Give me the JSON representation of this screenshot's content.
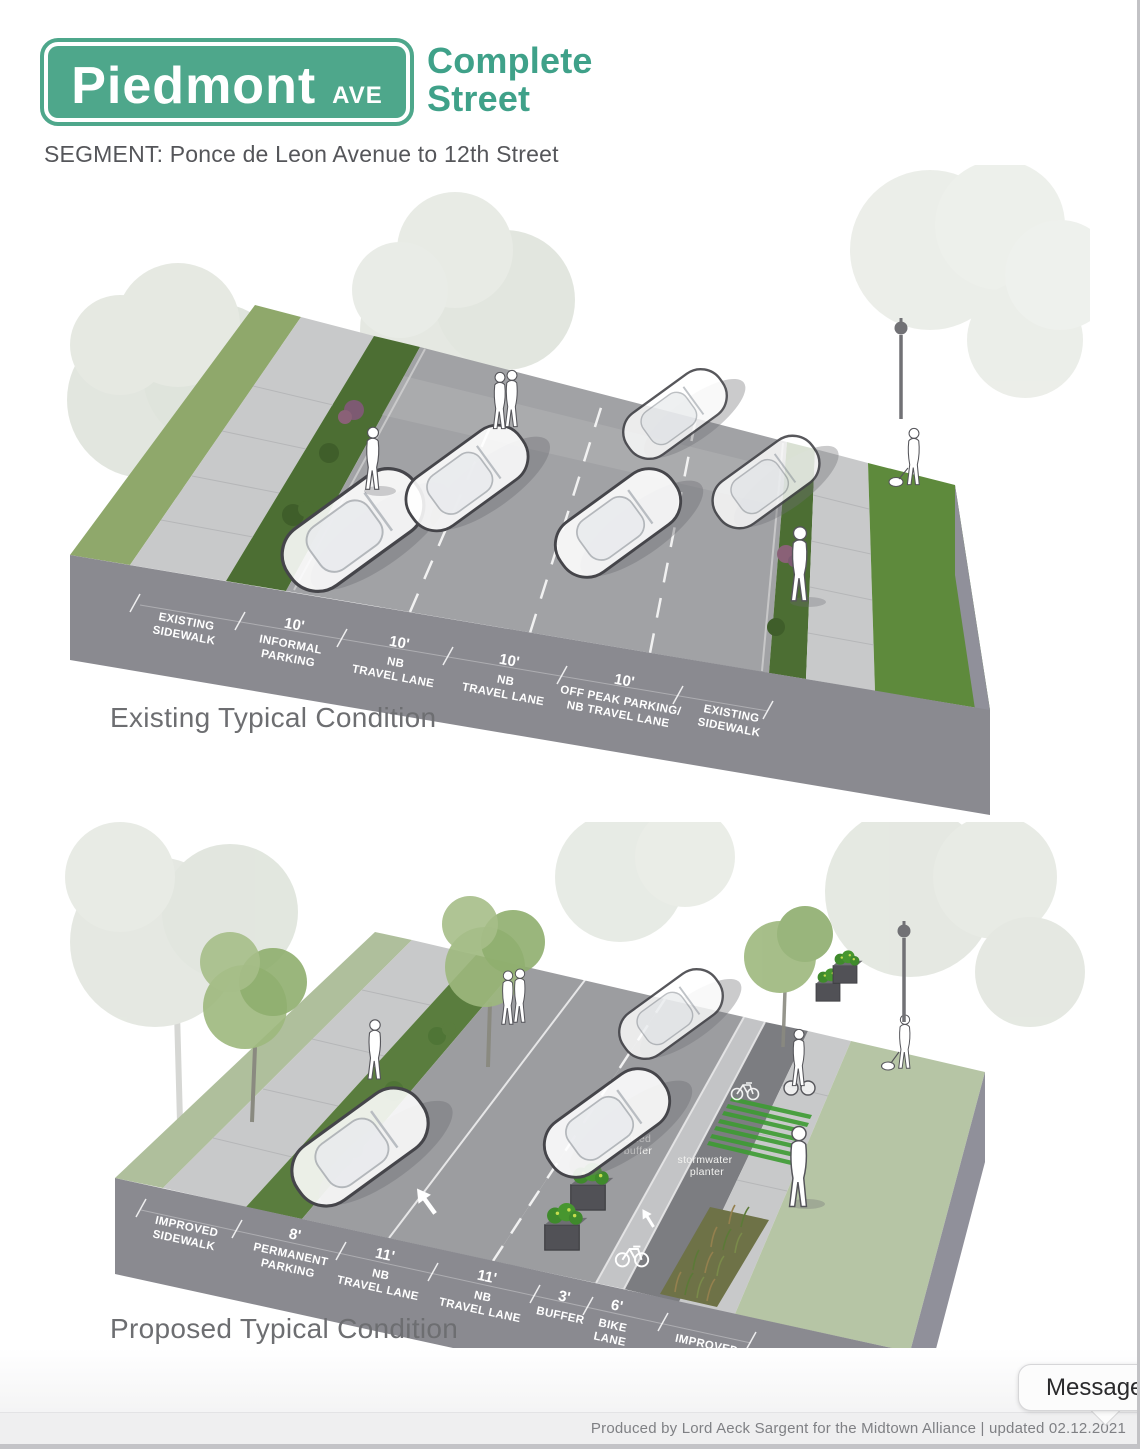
{
  "header": {
    "sign": {
      "name": "Piedmont",
      "suffix": "AVE"
    },
    "brand": {
      "line1": "Complete",
      "line2": "Street"
    },
    "segment": "SEGMENT: Ponce de Leon Avenue to 12th Street"
  },
  "existing": {
    "caption": "Existing Typical Condition",
    "segments": [
      {
        "dim": "",
        "l1": "EXISTING",
        "l2": "SIDEWALK"
      },
      {
        "dim": "10'",
        "l1": "INFORMAL",
        "l2": "PARKING"
      },
      {
        "dim": "10'",
        "l1": "NB",
        "l2": "TRAVEL LANE"
      },
      {
        "dim": "10'",
        "l1": "NB",
        "l2": "TRAVEL LANE"
      },
      {
        "dim": "10'",
        "l1": "OFF PEAK PARKING/",
        "l2": "NB TRAVEL LANE"
      },
      {
        "dim": "",
        "l1": "EXISTING",
        "l2": "SIDEWALK"
      }
    ]
  },
  "proposed": {
    "caption": "Proposed Typical Condition",
    "segments": [
      {
        "dim": "",
        "l1": "IMPROVED",
        "l2": "SIDEWALK"
      },
      {
        "dim": "8'",
        "l1": "PERMANENT",
        "l2": "PARKING"
      },
      {
        "dim": "11'",
        "l1": "NB",
        "l2": "TRAVEL LANE"
      },
      {
        "dim": "11'",
        "l1": "NB",
        "l2": "TRAVEL LANE"
      },
      {
        "dim": "3'",
        "l1": "BUFFER",
        "l2": ""
      },
      {
        "dim": "6'",
        "l1": "BIKE",
        "l2": "LANE"
      },
      {
        "dim": "",
        "l1": "IMPROVED",
        "l2": "SIDEWALK"
      }
    ],
    "annotations": {
      "raised_buffer": {
        "l1": "raised",
        "l2": "buffer"
      },
      "stormwater_planter": {
        "l1": "stormwater",
        "l2": "planter"
      }
    }
  },
  "footer": {
    "credit": "Produced by Lord Aeck Sargent for the Midtown Alliance  |  updated 02.12.2021"
  },
  "chat": {
    "label": "Message"
  },
  "colors": {
    "brand_green": "#4EA78B",
    "caption_gray": "#6D6E71",
    "face_gray": "#8A8A90",
    "road_gray": "#A1A2A5",
    "sidewalk_gray": "#C8C9CA",
    "hedge_green": "#4C6E33",
    "grass_green": "#5E8A3C",
    "sage_green": "#B5C4A4",
    "crosswalk_green": "#3D9C33"
  }
}
